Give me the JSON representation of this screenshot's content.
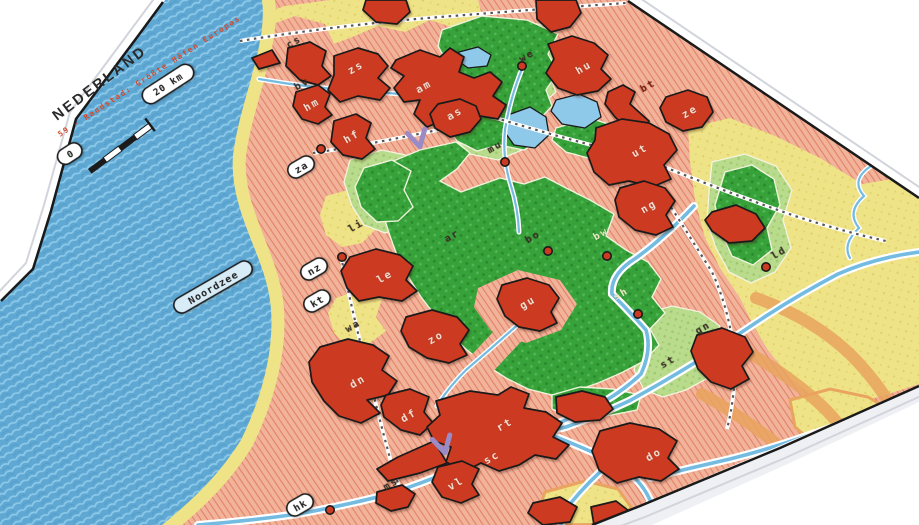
{
  "map": {
    "title": "NEDERLAND",
    "subtitle": "59 - Randstad: Größte Häfen Europas",
    "scale": {
      "zero_label": "0",
      "bar_label": "20 km"
    },
    "sea_label": "Noordzee",
    "labels": [
      {
        "id": "noordzee",
        "text": "Noordzee",
        "x": 213,
        "y": 287,
        "kind": "seapill",
        "w": 88
      },
      {
        "id": "za",
        "text": "za",
        "x": 301,
        "y": 167,
        "kind": "pill"
      },
      {
        "id": "nz",
        "text": "nz",
        "x": 314,
        "y": 269,
        "kind": "pill"
      },
      {
        "id": "kt",
        "text": "kt",
        "x": 317,
        "y": 301,
        "kind": "pill"
      },
      {
        "id": "hk",
        "text": "hk",
        "x": 300,
        "y": 505,
        "kind": "pill"
      },
      {
        "id": "cs",
        "text": "cs",
        "x": 294,
        "y": 42,
        "kind": "dark"
      },
      {
        "id": "bv",
        "text": "bv",
        "x": 302,
        "y": 84,
        "kind": "dark"
      },
      {
        "id": "li",
        "text": "li",
        "x": 356,
        "y": 226,
        "kind": "dark"
      },
      {
        "id": "wa",
        "text": "wa",
        "x": 353,
        "y": 326,
        "kind": "dark"
      },
      {
        "id": "ms",
        "text": "ms",
        "x": 391,
        "y": 484,
        "kind": "dark"
      },
      {
        "id": "mu",
        "text": "mu",
        "x": 495,
        "y": 147,
        "kind": "dark"
      },
      {
        "id": "we",
        "text": "we",
        "x": 527,
        "y": 56,
        "kind": "dark"
      },
      {
        "id": "ar",
        "text": "ar",
        "x": 452,
        "y": 236,
        "kind": "dark"
      },
      {
        "id": "bo",
        "text": "bo",
        "x": 533,
        "y": 237,
        "kind": "dark"
      },
      {
        "id": "ld",
        "text": "ld",
        "x": 779,
        "y": 253,
        "kind": "dark"
      },
      {
        "id": "st",
        "text": "st",
        "x": 668,
        "y": 362,
        "kind": "dark"
      },
      {
        "id": "gn",
        "text": "gn",
        "x": 703,
        "y": 328,
        "kind": "dark"
      },
      {
        "id": "bt",
        "text": "bt",
        "x": 648,
        "y": 86,
        "kind": "darkred"
      },
      {
        "id": "bw",
        "text": "bw",
        "x": 601,
        "y": 234,
        "kind": "green"
      },
      {
        "id": "sh",
        "text": "sh",
        "x": 621,
        "y": 294,
        "kind": "green"
      },
      {
        "id": "zs",
        "text": "zs",
        "x": 356,
        "y": 68,
        "kind": "red"
      },
      {
        "id": "hm",
        "text": "hm",
        "x": 312,
        "y": 105,
        "kind": "red"
      },
      {
        "id": "hf",
        "text": "hf",
        "x": 352,
        "y": 137,
        "kind": "red"
      },
      {
        "id": "am",
        "text": "am",
        "x": 424,
        "y": 87,
        "kind": "red"
      },
      {
        "id": "as",
        "text": "as",
        "x": 455,
        "y": 114,
        "kind": "red"
      },
      {
        "id": "hu",
        "text": "hu",
        "x": 584,
        "y": 68,
        "kind": "red"
      },
      {
        "id": "ze",
        "text": "ze",
        "x": 690,
        "y": 112,
        "kind": "red"
      },
      {
        "id": "ut",
        "text": "ut",
        "x": 640,
        "y": 151,
        "kind": "red"
      },
      {
        "id": "ng",
        "text": "ng",
        "x": 649,
        "y": 207,
        "kind": "red"
      },
      {
        "id": "le",
        "text": "le",
        "x": 385,
        "y": 277,
        "kind": "red"
      },
      {
        "id": "gu",
        "text": "gu",
        "x": 528,
        "y": 303,
        "kind": "red"
      },
      {
        "id": "zo",
        "text": "zo",
        "x": 436,
        "y": 338,
        "kind": "red"
      },
      {
        "id": "dn",
        "text": "dn",
        "x": 358,
        "y": 382,
        "kind": "red"
      },
      {
        "id": "df",
        "text": "df",
        "x": 409,
        "y": 416,
        "kind": "red"
      },
      {
        "id": "rt",
        "text": "rt",
        "x": 505,
        "y": 425,
        "kind": "red"
      },
      {
        "id": "sc",
        "text": "sc",
        "x": 492,
        "y": 458,
        "kind": "red"
      },
      {
        "id": "vl",
        "text": "vl",
        "x": 456,
        "y": 484,
        "kind": "red"
      },
      {
        "id": "do",
        "text": "do",
        "x": 654,
        "y": 455,
        "kind": "red"
      }
    ],
    "city_dots": [
      [
        321,
        149
      ],
      [
        342,
        257
      ],
      [
        522,
        66
      ],
      [
        505,
        162
      ],
      [
        548,
        251
      ],
      [
        607,
        256
      ],
      [
        638,
        314
      ],
      [
        766,
        267
      ],
      [
        330,
        510
      ]
    ],
    "airports": [
      [
        418,
        139
      ],
      [
        443,
        445
      ]
    ]
  },
  "colors": {
    "sea_base": "#5FA8D3",
    "sea_wave_light": "#8CC9E9",
    "sea_wave_dark": "#4A92BE",
    "urban_base": "#F1B39A",
    "urban_hatch": "#E28268",
    "city_red": "#CC3A21",
    "outline_black": "#1A1A1A",
    "forest_green": "#37A23A",
    "forest_dot": "#2B8A2E",
    "forest_dot2": "#52B755",
    "meadow_green": "#B9DC8C",
    "meadow_dot": "#9EC56F",
    "field_yellow": "#EFE387",
    "field_dot": "#E0CF68",
    "lake_blue": "#8FC9EA",
    "river_blue": "#74BBE2",
    "river_casing": "#FFFFFF",
    "railway_dash": "#565656",
    "orange_band": "#E9A45F",
    "airport_purple": "#9A8BC6",
    "page_white": "#FFFFFF",
    "page_edge": "#D2D4DB",
    "pill_bg": "#FFFFFF",
    "pill_sea_bg": "#D8ECF7",
    "pill_text": "#1C1C1C",
    "title_color": "#2A2A2A",
    "subtitle_red": "#D2492B",
    "label_cream": "#F8E3D5",
    "label_dark": "#3A2F24",
    "label_green_cream": "#F2EFC9",
    "label_darkred": "#7E1C0E"
  }
}
